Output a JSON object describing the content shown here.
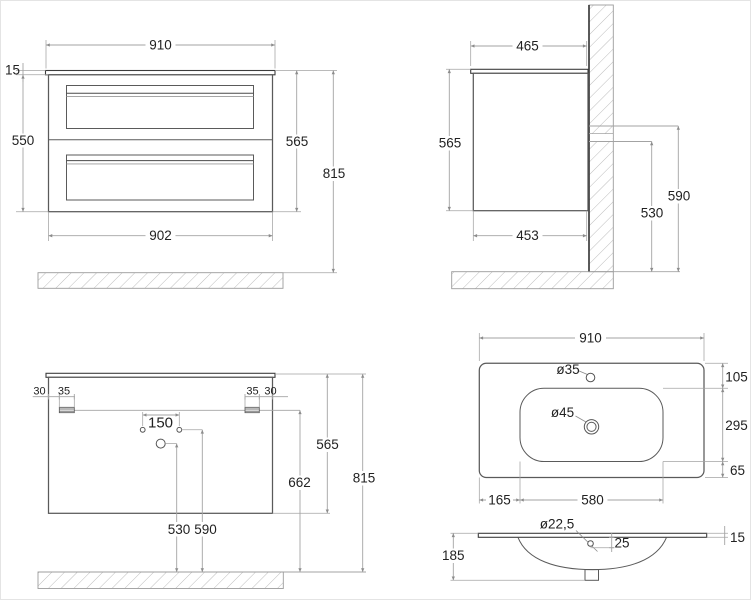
{
  "colors": {
    "background": "#ffffff",
    "object_line": "#5a5a5a",
    "edge_line": "#3d3d3d",
    "dimension_line": "#a3a3a3",
    "text": "#222222",
    "hatch_line": "#bdbdbd"
  },
  "views": {
    "front": {
      "width_top": "910",
      "top_thickness": "15",
      "body_height": "550",
      "height": "565",
      "total_height": "815",
      "width_body": "902"
    },
    "side": {
      "depth": "465",
      "height": "565",
      "body_depth": "453",
      "bracket_top_height": "590",
      "bracket_bottom_height": "530"
    },
    "rear": {
      "edge_offset_left": "30",
      "bracket_width_left": "35",
      "bracket_width_right": "35",
      "edge_offset_right": "30",
      "hole_spacing": "150",
      "height": "565",
      "bracket_to_floor": "662",
      "total_height": "815",
      "siphon_height": "530",
      "supply_height": "590"
    },
    "top": {
      "width": "910",
      "depth": "465",
      "faucet_hole": "ø35",
      "drain_hole": "ø45",
      "back_offset": "105",
      "bowl_depth": "295",
      "front_offset": "65",
      "bowl_left_offset": "165",
      "bowl_width": "580"
    },
    "section": {
      "overflow_hole": "ø22,5",
      "overflow_offset": "25",
      "edge_thickness": "15",
      "basin_depth": "185"
    }
  }
}
